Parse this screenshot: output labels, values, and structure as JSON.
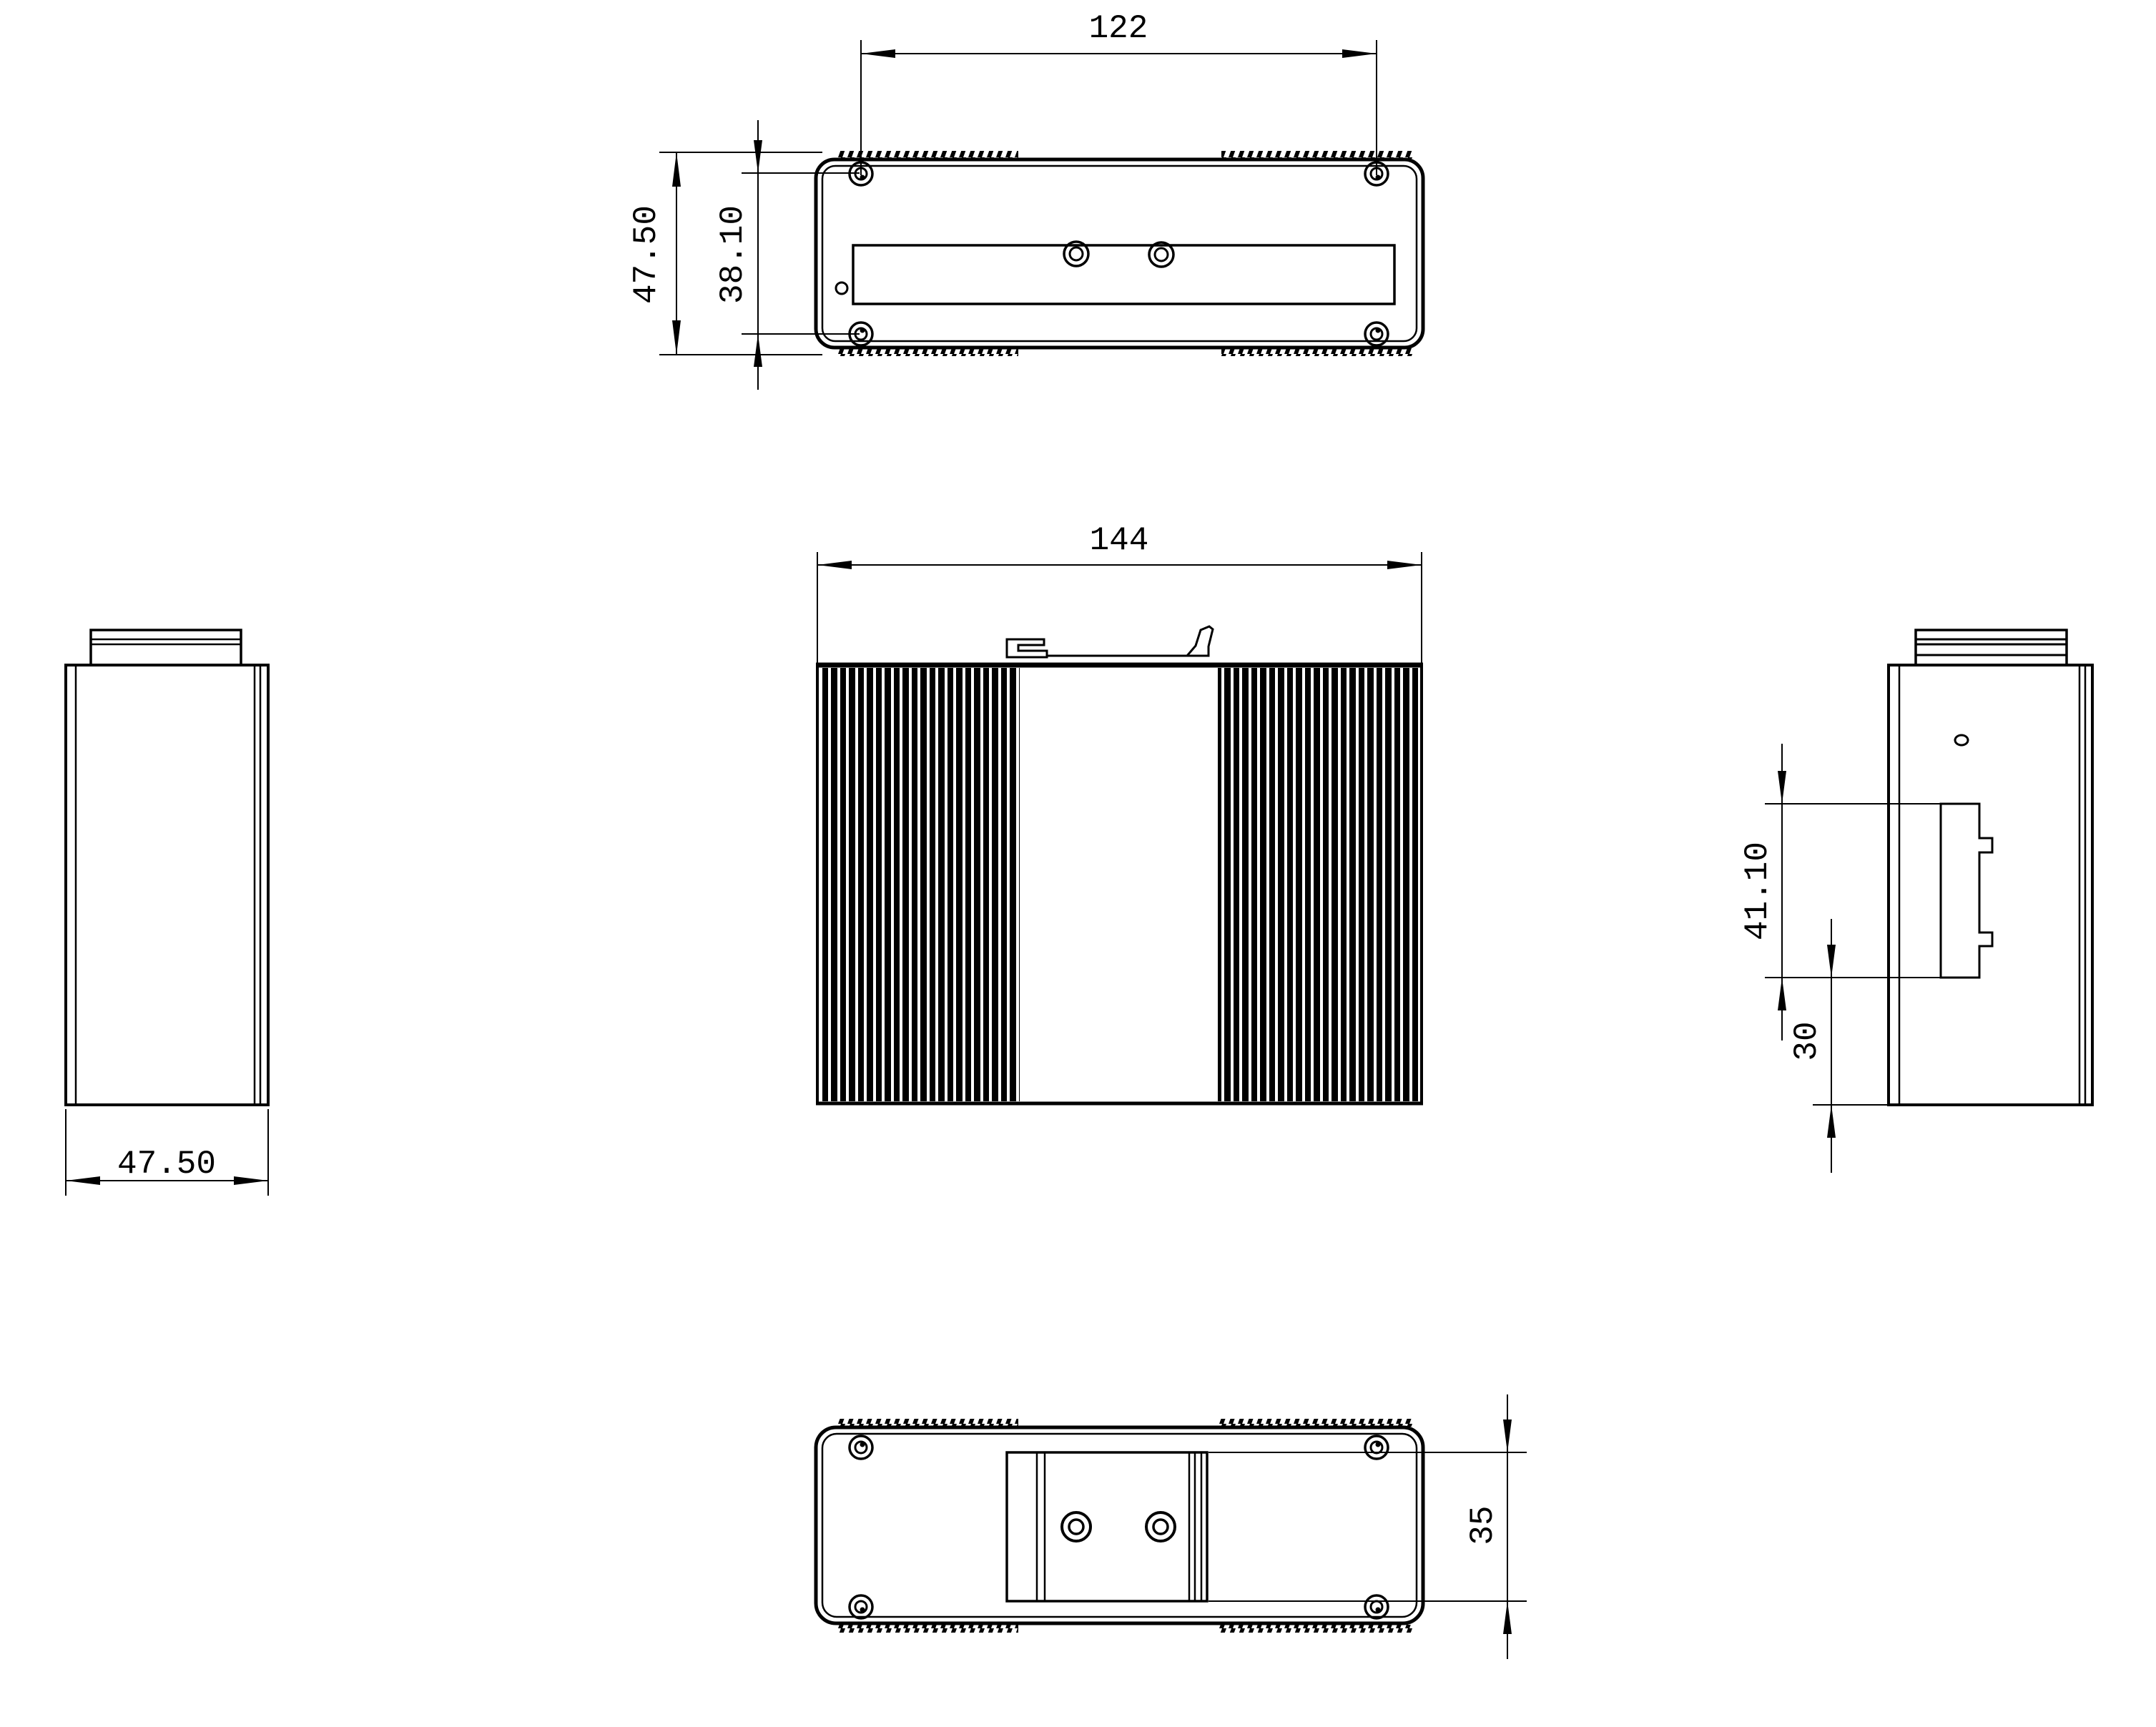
{
  "colors": {
    "background": "#ffffff",
    "line": "#000000"
  },
  "views": {
    "top": {
      "name": "Top view",
      "dims": {
        "hole_span": "122",
        "overall_depth": "47.50",
        "hole_row_spacing": "38.10"
      }
    },
    "front": {
      "name": "Front view",
      "dims": {
        "overall_width": "144"
      }
    },
    "left_side": {
      "name": "Left side view",
      "dims": {
        "overall_depth": "47.50"
      }
    },
    "right_side": {
      "name": "Right side view",
      "dims": {
        "bracket_height": "41.10",
        "bracket_to_bottom": "30"
      }
    },
    "bottom": {
      "name": "Bottom view",
      "dims": {
        "rail_plate_height": "35"
      }
    }
  }
}
